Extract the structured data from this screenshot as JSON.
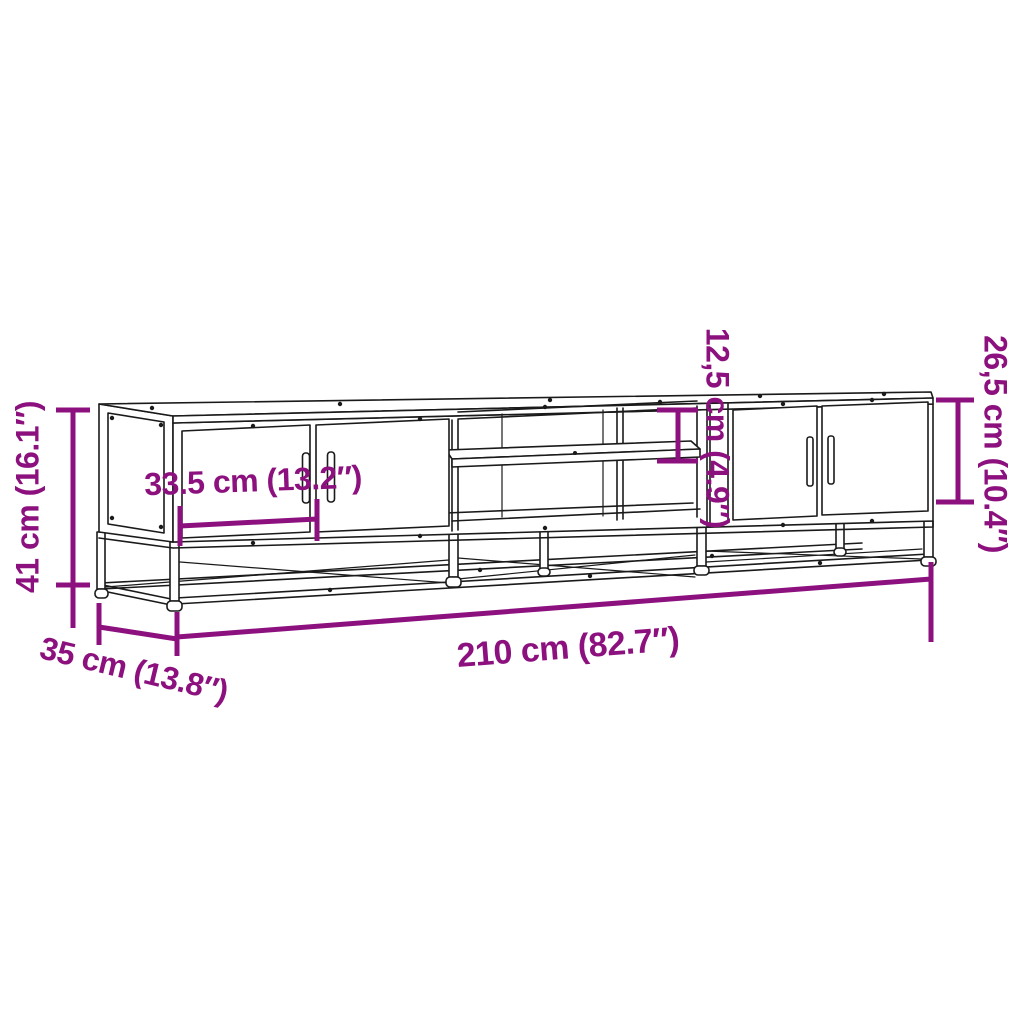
{
  "diagram": {
    "product": "tv-stand-dimension-diagram",
    "dimensions": {
      "height": {
        "label": "41 cm (16.1″)"
      },
      "depth": {
        "label": "35 cm (13.8″)"
      },
      "width": {
        "label": "210 cm (82.7″)"
      },
      "door_width": {
        "label": "33.5 cm (13.2″)"
      },
      "shelf_height": {
        "label": "12,5 cm (4.9″)"
      },
      "side_height": {
        "label": "26,5 cm (10.4″)"
      }
    }
  },
  "colors": {
    "dimension": "#8C117F",
    "line": "#1a1a1a",
    "background": "#ffffff"
  }
}
